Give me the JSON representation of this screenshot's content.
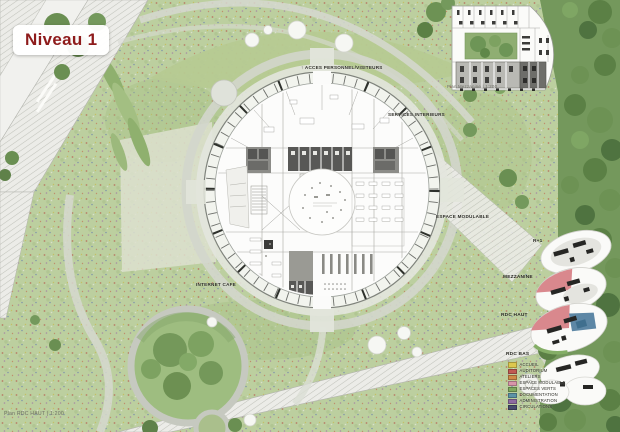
{
  "title": {
    "label": "Niveau 1"
  },
  "captions": {
    "main_plan": "Plan RDC HAUT | 1:200",
    "mezzanine_plan": "Plan Mezzanine | 1:200"
  },
  "plan_labels": {
    "access_arrow": "↑",
    "access": "ACCES PERSONNEL/VISITEURS",
    "services": "SERVICES INTERIEURS",
    "modular": "ESPACE MODULABLE",
    "internet": "INTERNET CAFE"
  },
  "level_diagrams": [
    {
      "label": "R+1"
    },
    {
      "label": "MEZZANINE"
    },
    {
      "label": "RDC HAUT"
    },
    {
      "label": "RDC BAS"
    }
  ],
  "legend": {
    "items": [
      {
        "label": "ACCUEIL",
        "color": "#ddc84e"
      },
      {
        "label": "AUDITORIUM",
        "color": "#c05a52"
      },
      {
        "label": "ATELIERS",
        "color": "#d08a47"
      },
      {
        "label": "ESPACE MODULABLE",
        "color": "#d795a9"
      },
      {
        "label": "ESPACES VERTS",
        "color": "#7fa95e"
      },
      {
        "label": "DOCUMENTATION",
        "color": "#5d93a6"
      },
      {
        "label": "ADMINISTRATION",
        "color": "#8d6ba0"
      },
      {
        "label": "CIRCULATIONS",
        "color": "#474b6e"
      }
    ]
  },
  "colors": {
    "accent_red": "#8e1b1b"
  }
}
